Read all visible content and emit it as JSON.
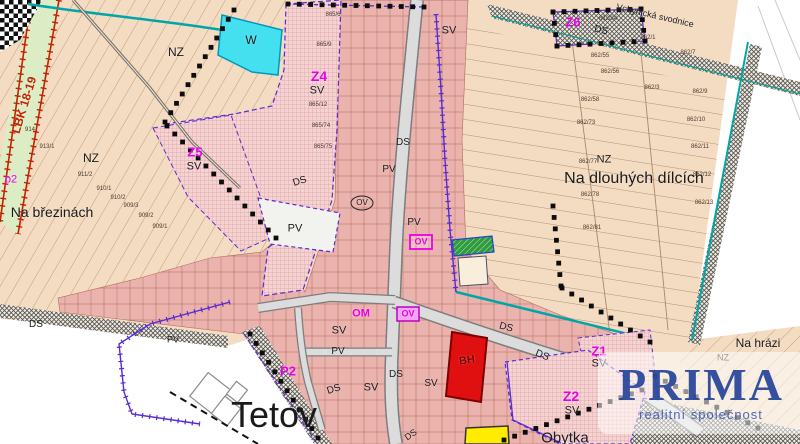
{
  "map": {
    "watermark": {
      "line1": "PRIMA",
      "line2": "realitní společnost"
    },
    "colors": {
      "field_beige": "#f4dcc2",
      "village_pink": "#eab3ae",
      "zone_pink": "#f6d3d3",
      "water_cyan": "#45e0f0",
      "biocorridor_green": "#dcedc6",
      "bh_red": "#e01010",
      "plot_yellow": "#ffec00",
      "zs_green": "#2f9b40",
      "boundary_purple": "#5a2bd0",
      "stream_teal": "#00a6a6",
      "label_magenta": "#e800e8",
      "logo_blue": "#1a3a96"
    },
    "labels": [
      {
        "t": "NZ",
        "x": 176,
        "y": 52,
        "s": 12
      },
      {
        "t": "NZ",
        "x": 91,
        "y": 158,
        "s": 12
      },
      {
        "t": "Na březinách",
        "x": 52,
        "y": 212,
        "s": 14
      },
      {
        "t": "W",
        "x": 251,
        "y": 40,
        "s": 12
      },
      {
        "t": "Z4",
        "x": 319,
        "y": 76,
        "s": 14,
        "c": "m",
        "b": 1
      },
      {
        "t": "SV",
        "x": 317,
        "y": 91,
        "s": 11
      },
      {
        "t": "Z5",
        "x": 195,
        "y": 152,
        "s": 13,
        "c": "m",
        "b": 1
      },
      {
        "t": "SV",
        "x": 194,
        "y": 167,
        "s": 11
      },
      {
        "t": "SV",
        "x": 449,
        "y": 31,
        "s": 11
      },
      {
        "t": "Z6",
        "x": 573,
        "y": 22,
        "s": 13,
        "c": "m",
        "b": 1
      },
      {
        "t": "NZ",
        "x": 604,
        "y": 160,
        "s": 11
      },
      {
        "t": "Na dlouhých dílcích",
        "x": 634,
        "y": 179,
        "s": 16
      },
      {
        "t": "Vchynická svodnice",
        "x": 655,
        "y": 16,
        "s": 9,
        "rot": 13
      },
      {
        "t": "DS",
        "x": 601,
        "y": 31,
        "s": 10,
        "rot": 13
      },
      {
        "t": "DS",
        "x": 403,
        "y": 143,
        "s": 10
      },
      {
        "t": "PV",
        "x": 389,
        "y": 170,
        "s": 10
      },
      {
        "t": "PV",
        "x": 414,
        "y": 223,
        "s": 10
      },
      {
        "t": "DS",
        "x": 300,
        "y": 182,
        "s": 10,
        "rot": -18
      },
      {
        "t": "PV",
        "x": 295,
        "y": 229,
        "s": 11
      },
      {
        "t": "OV",
        "x": 362,
        "y": 203,
        "s": 8
      },
      {
        "t": "OV",
        "x": 421,
        "y": 242,
        "s": 9,
        "c": "m",
        "b": 1
      },
      {
        "t": "OM",
        "x": 361,
        "y": 314,
        "s": 11,
        "c": "m",
        "b": 1
      },
      {
        "t": "OV",
        "x": 408,
        "y": 314,
        "s": 9,
        "c": "m",
        "b": 1
      },
      {
        "t": "SV",
        "x": 339,
        "y": 331,
        "s": 11
      },
      {
        "t": "PV",
        "x": 338,
        "y": 352,
        "s": 10
      },
      {
        "t": "P2",
        "x": 288,
        "y": 371,
        "s": 13,
        "c": "m",
        "b": 1
      },
      {
        "t": "DS",
        "x": 334,
        "y": 390,
        "s": 10,
        "rot": -18
      },
      {
        "t": "SV",
        "x": 371,
        "y": 388,
        "s": 11
      },
      {
        "t": "DS",
        "x": 506,
        "y": 328,
        "s": 10,
        "rot": 14
      },
      {
        "t": "DS",
        "x": 542,
        "y": 356,
        "s": 10,
        "rot": 22
      },
      {
        "t": "DS",
        "x": 396,
        "y": 375,
        "s": 10
      },
      {
        "t": "SV",
        "x": 431,
        "y": 384,
        "s": 10
      },
      {
        "t": "BH",
        "x": 467,
        "y": 361,
        "s": 11,
        "c": "d",
        "rot": -8,
        "b": 1
      },
      {
        "t": "Z1",
        "x": 599,
        "y": 351,
        "s": 13,
        "c": "m",
        "b": 1
      },
      {
        "t": "SV",
        "x": 599,
        "y": 364,
        "s": 11
      },
      {
        "t": "Z2",
        "x": 571,
        "y": 396,
        "s": 14,
        "c": "m",
        "b": 1
      },
      {
        "t": "SV",
        "x": 572,
        "y": 411,
        "s": 11
      },
      {
        "t": "Na hrázi",
        "x": 758,
        "y": 343,
        "s": 12
      },
      {
        "t": "NZ",
        "x": 723,
        "y": 358,
        "s": 9
      },
      {
        "t": "Tetov",
        "x": 274,
        "y": 415,
        "s": 36
      },
      {
        "t": "Obytka",
        "x": 565,
        "y": 438,
        "s": 15
      },
      {
        "t": "LBK 18-19",
        "x": 24,
        "y": 105,
        "s": 12,
        "c": "r",
        "rot": -73,
        "b": 1
      },
      {
        "t": "p2",
        "x": 11,
        "y": 180,
        "s": 11,
        "c": "m"
      },
      {
        "t": "DS",
        "x": 36,
        "y": 325,
        "s": 10
      },
      {
        "t": "PV",
        "x": 173,
        "y": 340,
        "s": 9
      },
      {
        "t": "DS",
        "x": 411,
        "y": 435,
        "s": 9,
        "rot": -35
      }
    ],
    "parcel_labels": [
      {
        "t": "914",
        "x": 30,
        "y": 130
      },
      {
        "t": "913/1",
        "x": 47,
        "y": 147
      },
      {
        "t": "911/2",
        "x": 85,
        "y": 175
      },
      {
        "t": "910/1",
        "x": 104,
        "y": 189
      },
      {
        "t": "910/2",
        "x": 118,
        "y": 198
      },
      {
        "t": "909/3",
        "x": 131,
        "y": 206
      },
      {
        "t": "909/2",
        "x": 146,
        "y": 216
      },
      {
        "t": "909/1",
        "x": 160,
        "y": 227
      },
      {
        "t": "865/6",
        "x": 333,
        "y": 15
      },
      {
        "t": "865/9",
        "x": 324,
        "y": 45
      },
      {
        "t": "865/12",
        "x": 318,
        "y": 105
      },
      {
        "t": "865/74",
        "x": 321,
        "y": 126
      },
      {
        "t": "865/75",
        "x": 323,
        "y": 147
      },
      {
        "t": "862/34",
        "x": 608,
        "y": 19
      },
      {
        "t": "862/1",
        "x": 648,
        "y": 38
      },
      {
        "t": "862/55",
        "x": 600,
        "y": 56
      },
      {
        "t": "862/56",
        "x": 610,
        "y": 72
      },
      {
        "t": "862/3",
        "x": 652,
        "y": 88
      },
      {
        "t": "862/7",
        "x": 688,
        "y": 53
      },
      {
        "t": "862/58",
        "x": 590,
        "y": 100
      },
      {
        "t": "862/9",
        "x": 700,
        "y": 92
      },
      {
        "t": "862/73",
        "x": 586,
        "y": 123
      },
      {
        "t": "862/10",
        "x": 696,
        "y": 120
      },
      {
        "t": "862/77",
        "x": 588,
        "y": 162
      },
      {
        "t": "862/11",
        "x": 700,
        "y": 147
      },
      {
        "t": "862/78",
        "x": 590,
        "y": 195
      },
      {
        "t": "862/12",
        "x": 702,
        "y": 175
      },
      {
        "t": "862/81",
        "x": 592,
        "y": 228
      },
      {
        "t": "862/13",
        "x": 704,
        "y": 203
      }
    ]
  }
}
